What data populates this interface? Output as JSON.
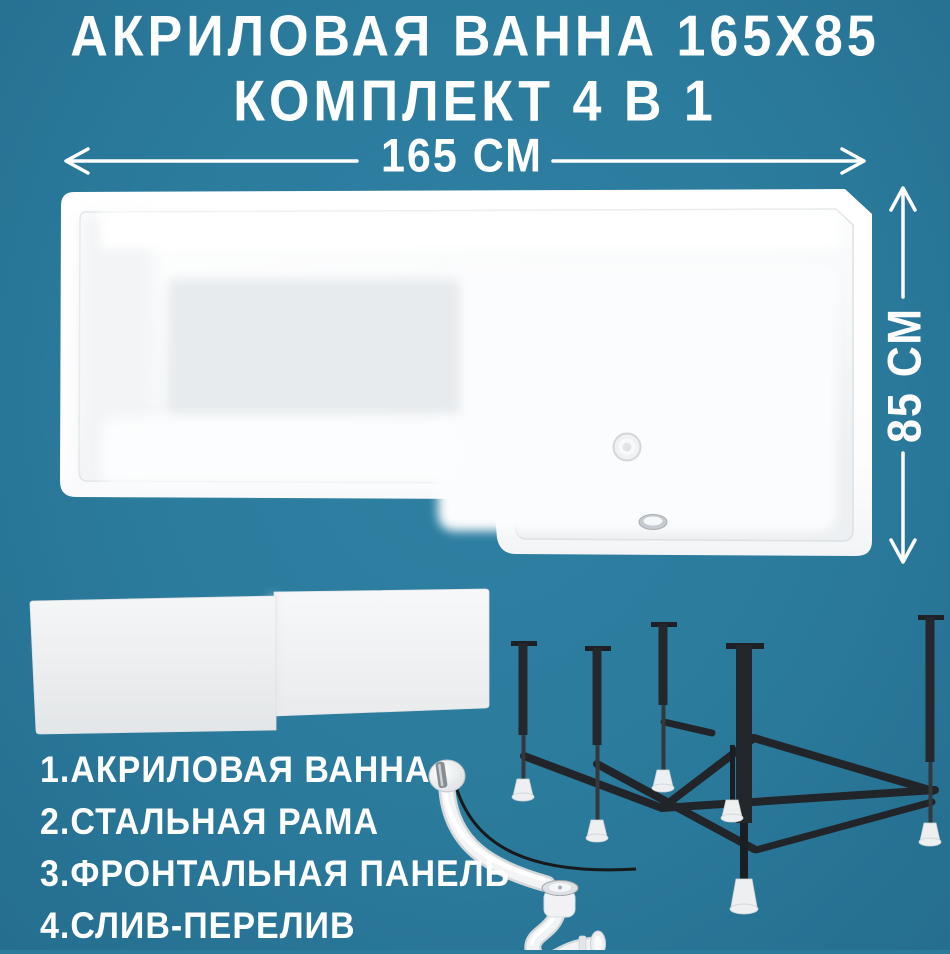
{
  "background_color": "#2b7b9d",
  "text_color": "#ffffff",
  "title": {
    "line1": "АКРИЛОВАЯ ВАННА 165Х85",
    "line2": "КОМПЛЕКТ 4 В 1"
  },
  "dimensions": {
    "width_label": "165 СМ",
    "height_label": "85 СМ"
  },
  "parts_list": [
    "1.АКРИЛОВАЯ ВАННА",
    "2.СТАЛЬНАЯ РАМА",
    "3.ФРОНТАЛЬНАЯ ПАНЕЛЬ",
    "4.СЛИВ-ПЕРЕЛИВ"
  ],
  "figures": {
    "bathtub": "bathtub-top-view",
    "front_panels": "front-panel-pair",
    "steel_frame": "steel-frame",
    "drain_overflow": "drain-overflow-siphon"
  },
  "palette": {
    "background": "#2b7b9d",
    "text": "#ffffff",
    "product_white": "#f5f6f7",
    "floor_gray": "#e8ebee",
    "frame_black": "#22262a",
    "chrome": "#c7ccd0"
  }
}
